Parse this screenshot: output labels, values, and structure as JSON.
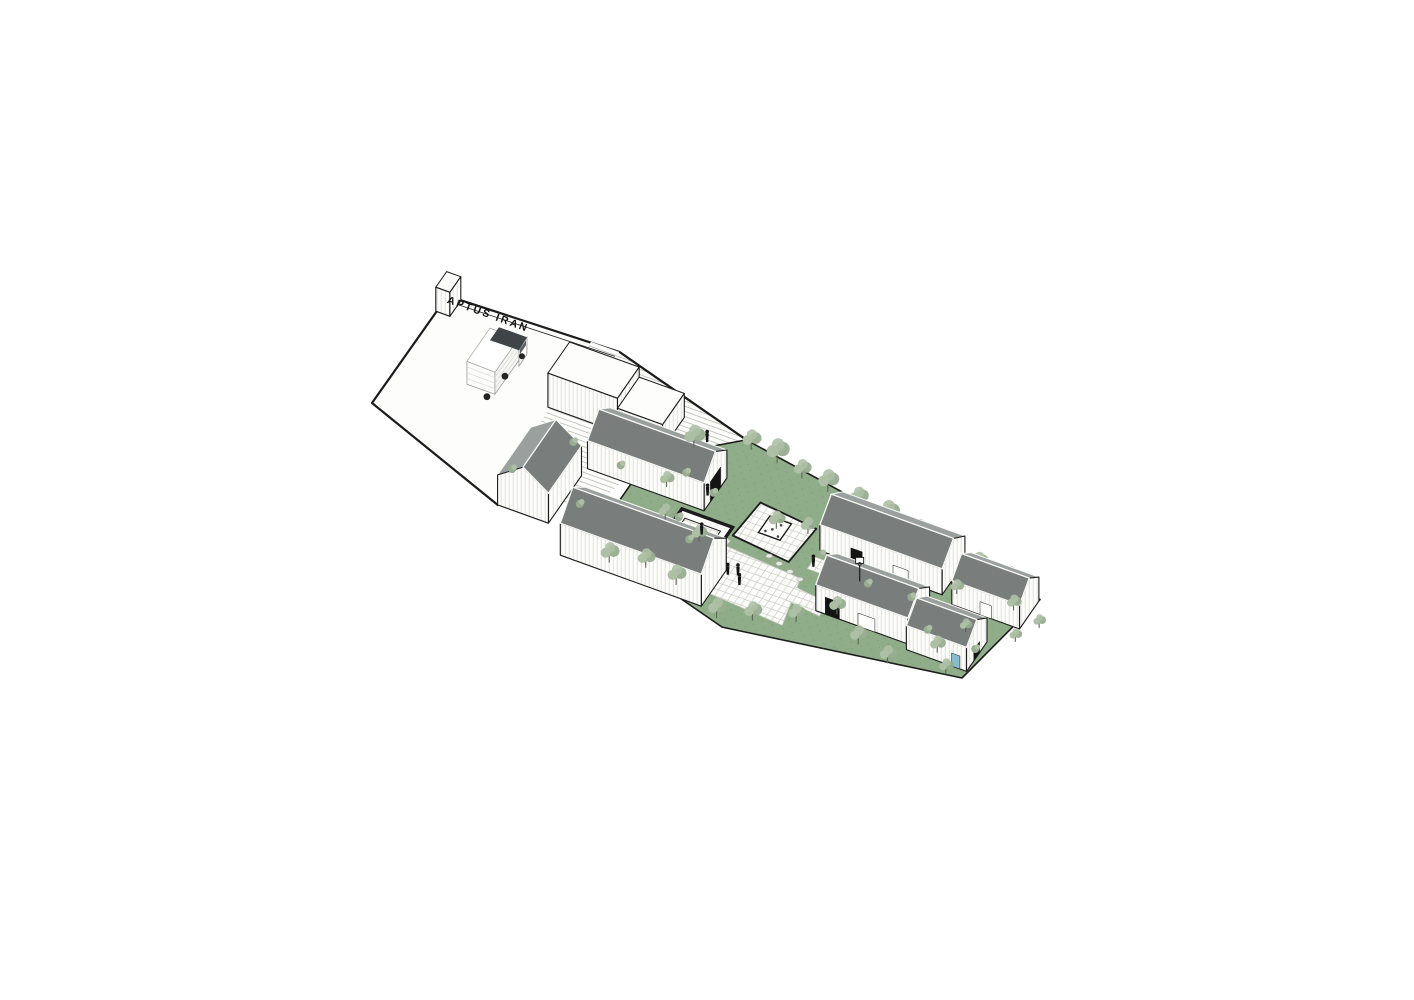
{
  "title": "Axonometric site drawing",
  "sign": {
    "text": "APTUS IRAN",
    "u": 4,
    "v": 124,
    "rotation": 19.9
  },
  "colors": {
    "background": "#ffffff",
    "outline": "#1c1c1c",
    "dark": "#141414",
    "wall": "#fdfdfb",
    "hatch": "#dedbd4",
    "lawn": "#8fad88",
    "grass_dot": "#7fa079",
    "roof_near": "#797d7c",
    "roof_far": "#9aa09d",
    "roof_edge": "#f8f8f6",
    "steps_line": "#c6c6c0",
    "pave_line": "#ccccc6",
    "stone": "#e9e9e3",
    "tree_light": "#adc0a5",
    "tree_mid": "#97ad8f",
    "trunk": "#5d6655",
    "truck_dark": "#3f4447",
    "water": "#85bdd1"
  },
  "projection": {
    "origin": [
      372,
      403
    ],
    "e1": [
      0.94,
      0.34
    ],
    "e2": [
      0.57,
      -0.82
    ]
  },
  "scene": {
    "grounds": [
      {
        "name": "forecourt",
        "pts": [
          [
            0,
            0
          ],
          [
            1,
            131
          ],
          [
            180,
            137
          ],
          [
            340,
            96
          ],
          [
            270,
            42
          ],
          [
            167,
            -55
          ]
        ],
        "fill": "wall",
        "stroke": "outline",
        "sw": 2.2
      },
      {
        "name": "steps-terraces",
        "pts": [
          [
            150,
            137
          ],
          [
            180,
            137
          ],
          [
            340,
            96
          ],
          [
            268,
            44
          ],
          [
            248,
            -30
          ],
          [
            158,
            -30
          ]
        ],
        "fill": "steps"
      },
      {
        "name": "site-boundary-top",
        "pts": [
          [
            180,
            137
          ],
          [
            340,
            96
          ]
        ],
        "stroke": "outline",
        "sw": 2.2
      },
      {
        "name": "forecourt-wall-line",
        "pts": [
          [
            10,
            126
          ],
          [
            179,
            131
          ]
        ],
        "stroke": "outline",
        "sw": 0.8
      },
      {
        "name": "lawn",
        "pts": [
          [
            268,
            44
          ],
          [
            340,
            96
          ],
          [
            684,
            44
          ],
          [
            664,
            -60
          ],
          [
            430,
            -95
          ],
          [
            300,
            -62
          ],
          [
            268,
            -10
          ]
        ],
        "fill": "lawn",
        "stroke": "outline",
        "sw": 1.6
      },
      {
        "name": "plaza",
        "pts": [
          [
            378,
            -14
          ],
          [
            468,
            -20
          ],
          [
            480,
            -72
          ],
          [
            388,
            -66
          ]
        ],
        "fill": "pave",
        "stroke": "pave_line",
        "sw": 0.8
      },
      {
        "name": "platform-deck",
        "pts": [
          [
            385,
            -2
          ],
          [
            448,
            -8
          ],
          [
            452,
            34
          ],
          [
            389,
            40
          ]
        ],
        "fill": "pave",
        "stroke": "outline",
        "sw": 1.8
      },
      {
        "name": "path-to-pavilion",
        "pts": [
          [
            352,
            -2
          ],
          [
            386,
            -8
          ],
          [
            384,
            -24
          ],
          [
            350,
            -18
          ]
        ],
        "fill": "pave",
        "stroke": "pave_line",
        "sw": 0.7
      },
      {
        "name": "path-right-courtyard",
        "pts": [
          [
            468,
            -8
          ],
          [
            600,
            -8
          ],
          [
            600,
            6
          ],
          [
            468,
            6
          ]
        ],
        "fill": "pave",
        "stroke": "pave_line",
        "sw": 0.7
      },
      {
        "name": "path-plaza-right",
        "pts": [
          [
            468,
            -30
          ],
          [
            506,
            -34
          ],
          [
            506,
            -50
          ],
          [
            468,
            -46
          ]
        ],
        "fill": "pave",
        "stroke": "pave_line",
        "sw": 0.7
      }
    ],
    "pool_pavilion": {
      "outer": [
        [
          326,
          6
        ],
        [
          380,
          6
        ],
        [
          380,
          -40
        ],
        [
          326,
          -40
        ]
      ],
      "inner": [
        [
          334,
          -2
        ],
        [
          372,
          -2
        ],
        [
          372,
          -32
        ],
        [
          334,
          -32
        ]
      ],
      "basin": [
        [
          341,
          -8
        ],
        [
          365,
          -8
        ],
        [
          365,
          -25
        ],
        [
          341,
          -25
        ]
      ],
      "table": [
        353,
        -16
      ]
    },
    "pergola": {
      "quad": [
        [
          405,
          10
        ],
        [
          428,
          10
        ],
        [
          428,
          30
        ],
        [
          405,
          30
        ]
      ],
      "dots": [
        [
          410,
          14
        ],
        [
          420,
          25
        ],
        [
          415,
          18
        ],
        [
          424,
          13
        ],
        [
          408,
          26
        ]
      ]
    },
    "stones": [
      [
        428,
        -9
      ],
      [
        441,
        -13
      ],
      [
        455,
        -17
      ],
      [
        468,
        -21
      ]
    ],
    "buildings": [
      {
        "name": "gate-block",
        "type": "flat",
        "u": 0,
        "v": 112,
        "len": 15,
        "wid": 19,
        "h": 24
      },
      {
        "name": "warehouse-stepped-tall",
        "type": "flat",
        "u": 152,
        "v": 58,
        "len": 74,
        "wid": 38,
        "h": 34
      },
      {
        "name": "warehouse-stepped-low",
        "type": "flat",
        "u": 226,
        "v": 58,
        "len": 48,
        "wid": 38,
        "h": 24
      },
      {
        "name": "warehouse-upper",
        "type": "gable",
        "axis": "e1",
        "u": 222,
        "v": 12,
        "len": 124,
        "wid": 40,
        "h": 28,
        "r": 15,
        "openings": [
          {
            "face": "gable",
            "w": 18,
            "hh": 20,
            "fill": "dark"
          }
        ]
      },
      {
        "name": "workshop-small",
        "type": "gable",
        "axis": "e2",
        "u": 167,
        "v": -55,
        "len": 58,
        "wid": 54,
        "h": 30,
        "r": 17
      },
      {
        "name": "warehouse-lower",
        "type": "gable",
        "axis": "e1",
        "u": 250,
        "v": -82,
        "len": 150,
        "wid": 44,
        "h": 32,
        "r": 18
      },
      {
        "name": "house-north",
        "type": "gable",
        "axis": "e1",
        "u": 468,
        "v": 14,
        "len": 130,
        "wid": 40,
        "h": 26,
        "r": 14,
        "openings": [
          {
            "face": "wall",
            "t": 0.3,
            "w": 12,
            "hh": 14,
            "fill": "dark"
          },
          {
            "face": "wall",
            "t": 0.66,
            "w": 16,
            "hh": 12,
            "fill": "wall"
          }
        ]
      },
      {
        "name": "house-northeast",
        "type": "gable",
        "axis": "e1",
        "u": 612,
        "v": 8,
        "len": 72,
        "wid": 34,
        "h": 24,
        "r": 13,
        "openings": [
          {
            "face": "wall",
            "t": 0.5,
            "w": 12,
            "hh": 13,
            "fill": "wall"
          }
        ]
      },
      {
        "name": "house-south",
        "type": "gable",
        "axis": "e1",
        "u": 500,
        "v": -46,
        "len": 98,
        "wid": 38,
        "h": 26,
        "r": 14,
        "openings": [
          {
            "face": "wall",
            "t": 0.18,
            "w": 15,
            "hh": 17,
            "fill": "dark"
          },
          {
            "face": "wall",
            "t": 0.55,
            "w": 18,
            "hh": 13,
            "fill": "wall"
          }
        ]
      },
      {
        "name": "house-southeast",
        "type": "gable",
        "axis": "e1",
        "u": 600,
        "v": -52,
        "len": 64,
        "wid": 36,
        "h": 24,
        "r": 13,
        "openings": [
          {
            "face": "wall",
            "t": 0.82,
            "w": 9,
            "hh": 13,
            "fill": "water"
          },
          {
            "face": "gable",
            "w": 10,
            "hh": 11,
            "fill": "dark"
          }
        ]
      }
    ],
    "trees_back": [
      [
        300,
        70,
        1
      ],
      [
        350,
        88,
        0.9
      ],
      [
        380,
        84,
        1.1
      ],
      [
        410,
        78,
        0.85
      ],
      [
        440,
        74,
        1
      ],
      [
        475,
        70,
        0.9
      ],
      [
        510,
        64,
        1.05
      ],
      [
        545,
        60,
        0.9
      ],
      [
        580,
        56,
        1
      ],
      [
        615,
        50,
        0.85
      ],
      [
        650,
        46,
        0.9
      ],
      [
        300,
        22,
        0.7
      ],
      [
        318,
        -10,
        0.7
      ],
      [
        360,
        -20,
        0.75
      ],
      [
        448,
        26,
        0.75
      ],
      [
        418,
        20,
        0.8
      ]
    ],
    "trees_front": [
      [
        296,
        -72,
        0.9
      ],
      [
        330,
        -64,
        0.85
      ],
      [
        366,
        -70,
        0.9
      ],
      [
        420,
        -88,
        0.9
      ],
      [
        452,
        -78,
        0.85
      ],
      [
        490,
        -64,
        0.8
      ],
      [
        520,
        -42,
        0.8
      ],
      [
        556,
        -64,
        0.85
      ],
      [
        592,
        -72,
        0.8
      ],
      [
        628,
        -44,
        0.75
      ],
      [
        648,
        -62,
        0.7
      ],
      [
        610,
        20,
        0.65
      ],
      [
        640,
        -14,
        0.6
      ],
      [
        668,
        24,
        0.7
      ],
      [
        688,
        -6,
        0.6
      ],
      [
        700,
        16,
        0.6
      ]
    ],
    "shrubs": [
      [
        196,
        30
      ],
      [
        238,
        -28
      ],
      [
        250,
        24
      ],
      [
        160,
        -18
      ],
      [
        345,
        30
      ],
      [
        352,
        -24
      ],
      [
        310,
        40
      ],
      [
        330,
        -6
      ],
      [
        473,
        8
      ],
      [
        530,
        -4
      ],
      [
        575,
        -2
      ],
      [
        608,
        -28
      ],
      [
        660,
        -30
      ]
    ],
    "people": [
      [
        308,
        80
      ],
      [
        340,
        28
      ],
      [
        404,
        -42
      ],
      [
        413,
        -39
      ],
      [
        420,
        -48
      ],
      [
        472,
        -4
      ],
      [
        358,
        -12
      ]
    ],
    "truck": {
      "u": 88,
      "v": 46
    },
    "hoop": {
      "u": 520,
      "v": -2
    }
  }
}
